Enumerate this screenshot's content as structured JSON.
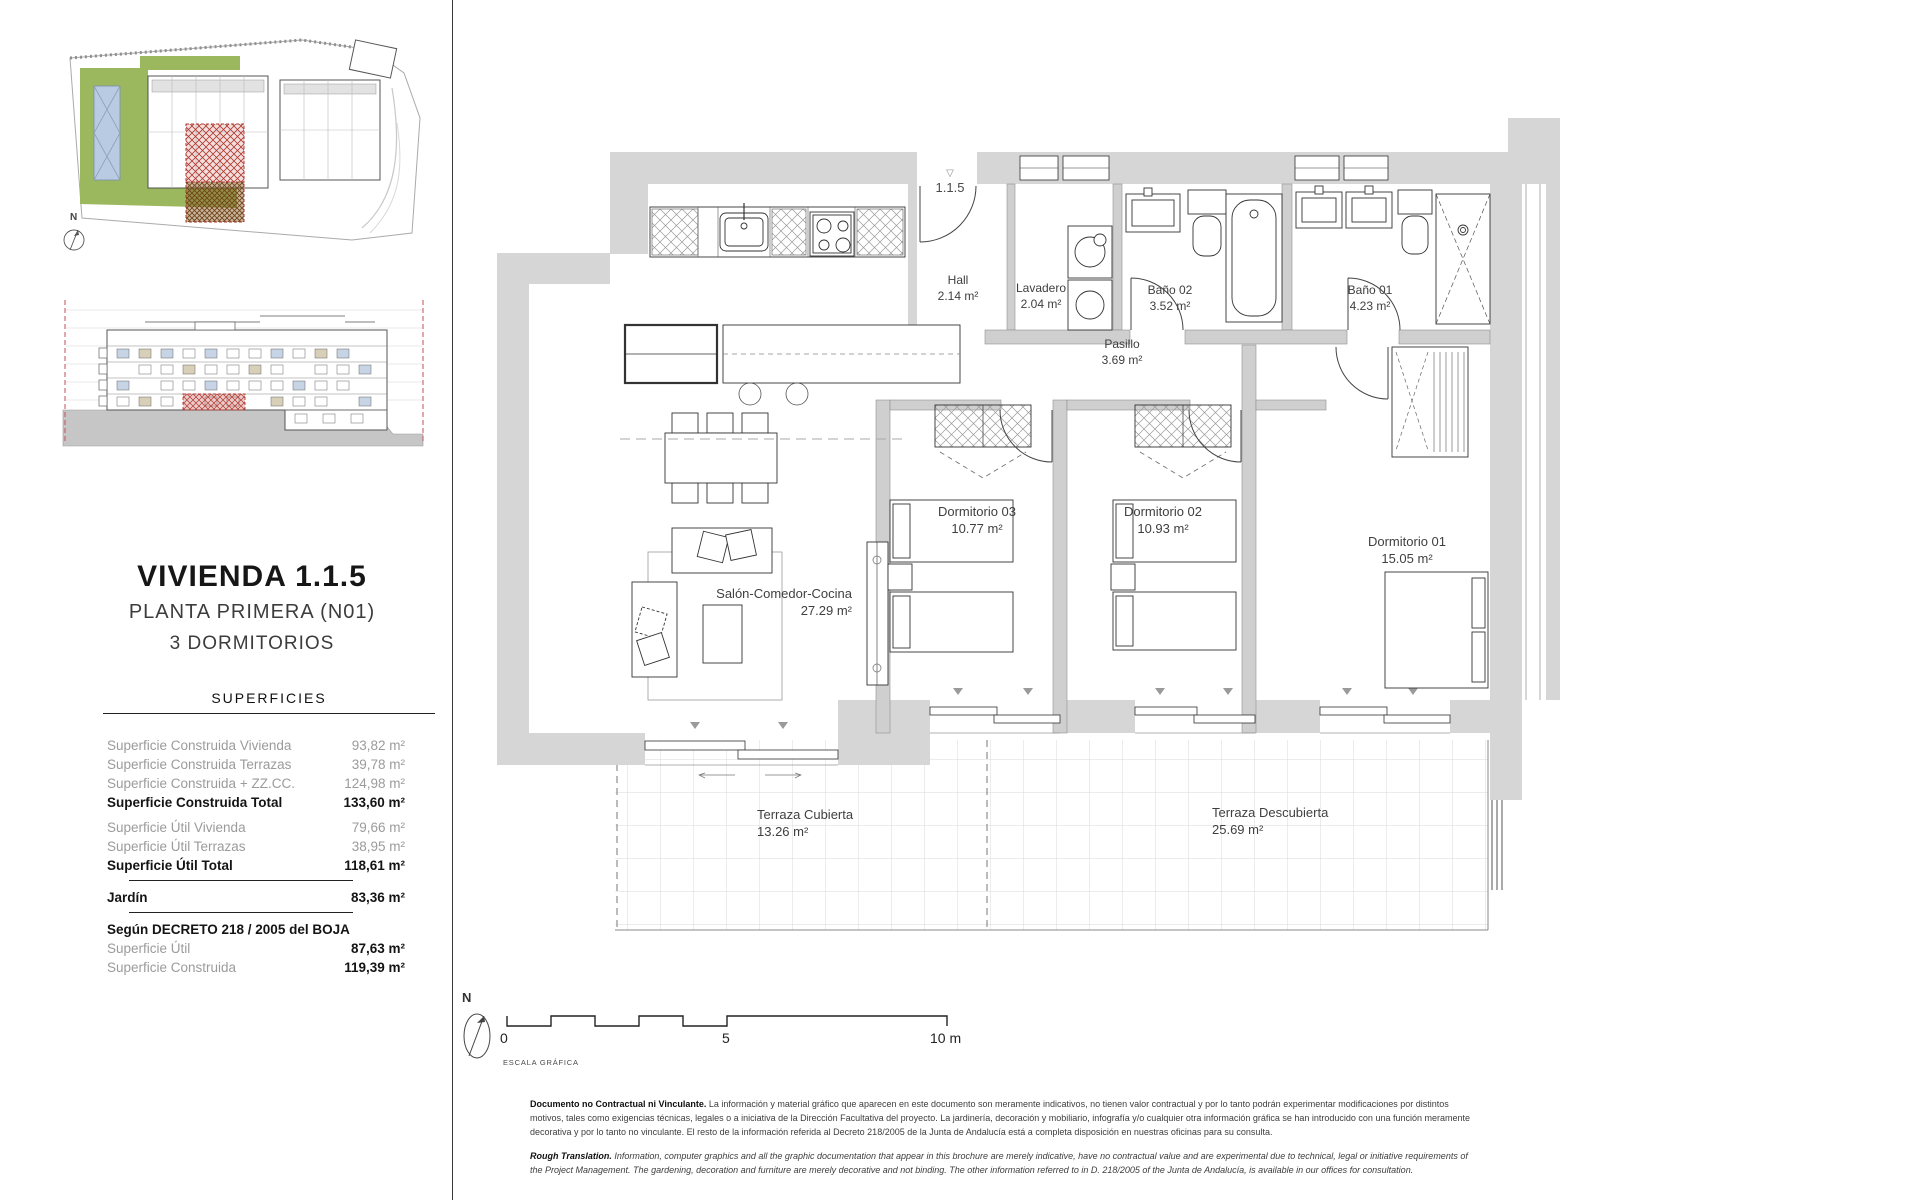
{
  "unit": {
    "title": "VIVIENDA 1.1.5",
    "floor": "PLANTA PRIMERA (N01)",
    "bedrooms": "3 DORMITORIOS",
    "entrance_tag": "1.1.5"
  },
  "surfaces": {
    "header": "SUPERFICIES",
    "rows": [
      {
        "label": "Superficie Construida Vivienda",
        "value": "93,82 m²"
      },
      {
        "label": "Superficie Construida Terrazas",
        "value": "39,78 m²"
      },
      {
        "label": "Superficie Construida + ZZ.CC.",
        "value": "124,98 m²"
      },
      {
        "label": "Superficie Construida Total",
        "value": "133,60 m²"
      },
      {
        "label": "Superficie Útil Vivienda",
        "value": "79,66 m²"
      },
      {
        "label": "Superficie Útil Terrazas",
        "value": "38,95 m²"
      },
      {
        "label": "Superficie Útil Total",
        "value": "118,61 m²"
      }
    ],
    "jardin": {
      "label": "Jardín",
      "value": "83,36 m²"
    },
    "decree_header": "Según DECRETO 218 / 2005 del BOJA",
    "decree_rows": [
      {
        "label": "Superficie Útil",
        "value": "87,63 m²"
      },
      {
        "label": "Superficie Construida",
        "value": "119,39 m²"
      }
    ]
  },
  "plan": {
    "rooms": [
      {
        "name": "Hall",
        "area": "2.14 m²"
      },
      {
        "name": "Lavadero",
        "area": "2.04 m²"
      },
      {
        "name": "Baño 02",
        "area": "3.52 m²"
      },
      {
        "name": "Baño 01",
        "area": "4.23 m²"
      },
      {
        "name": "Pasillo",
        "area": "3.69 m²"
      },
      {
        "name": "Dormitorio 03",
        "area": "10.77 m²"
      },
      {
        "name": "Dormitorio 02",
        "area": "10.93 m²"
      },
      {
        "name": "Dormitorio 01",
        "area": "15.05 m²"
      },
      {
        "name": "Salón-Comedor-Cocina",
        "area": "27.29 m²"
      },
      {
        "name": "Terraza Cubierta",
        "area": "13.26 m²"
      },
      {
        "name": "Terraza Descubierta",
        "area": "25.69 m²"
      }
    ]
  },
  "scale": {
    "tick0": "0",
    "tick5": "5",
    "tick10": "10 m",
    "caption": "ESCALA GRÁFICA",
    "north": "N"
  },
  "disclaimer": {
    "es_lead": "Documento no Contractual ni Vinculante.",
    "es_body": " La información y material gráfico que aparecen en este documento son meramente indicativos, no tienen valor contractual y por lo tanto podrán experimentar modificaciones por distintos motivos, tales como exigencias técnicas, legales o a iniciativa de la Dirección Facultativa del proyecto. La jardinería, decoración y mobiliario, infografía y/o cualquier otra información gráfica se han introducido con una función meramente decorativa y por lo tanto no vinculante. El resto de la información referida al Decreto 218/2005 de la Junta de Andalucía está a completa disposición en nuestras oficinas para su consulta.",
    "en_lead": "Rough Translation.",
    "en_body": " Information, computer graphics and all the graphic documentation that appear in this brochure are merely indicative, have no contractual value and are experimental due to technical, legal or initiative requirements of the Project Management. The gardening, decoration and furniture are merely decorative and not binding. The other information referred to in D. 218/2005 of the Junta de Andalucía, is available in our offices for consultation."
  },
  "colors": {
    "wall_gray": "#d6d6d6",
    "highlight_red": "#b0392e",
    "site_green": "#9cb85f",
    "pool_blue": "#b9cbe3"
  }
}
